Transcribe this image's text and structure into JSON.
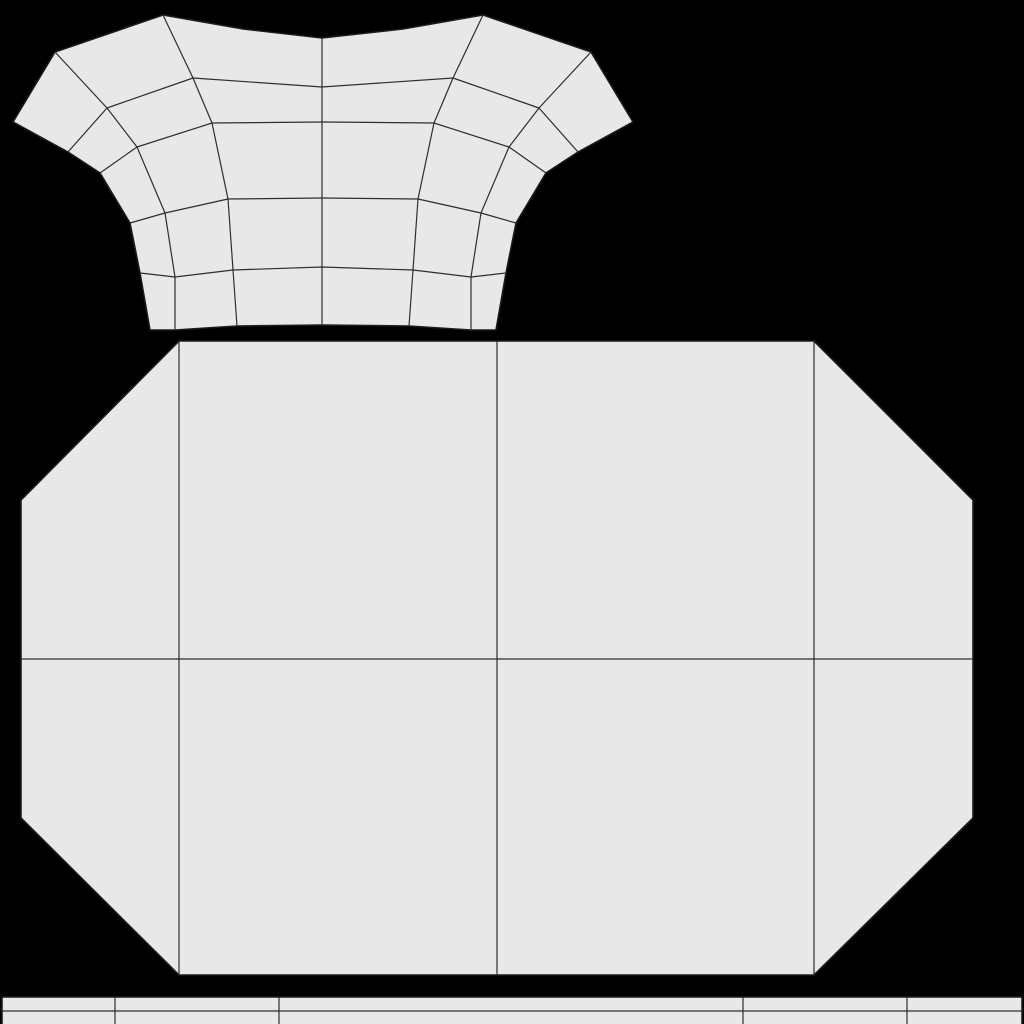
{
  "canvas": {
    "width": 1024,
    "height": 1024,
    "background_color": "#000000"
  },
  "style": {
    "island_fill_color": "#e8e8e8",
    "outline_color": "#1c1c1c",
    "wire_color": "#2e2e2e",
    "outline_width": 1.6,
    "wire_width": 1.2
  },
  "islands": [
    {
      "id": "torso-uv-island",
      "outline": [
        [
          13,
          122
        ],
        [
          55,
          52
        ],
        [
          163,
          15
        ],
        [
          243,
          29
        ],
        [
          322,
          38
        ],
        [
          403,
          29
        ],
        [
          483,
          15
        ],
        [
          591,
          52
        ],
        [
          633,
          122
        ],
        [
          578,
          152
        ],
        [
          546,
          173
        ],
        [
          516,
          223
        ],
        [
          506,
          273
        ],
        [
          496,
          330
        ],
        [
          471,
          330
        ],
        [
          409,
          326
        ],
        [
          322,
          325
        ],
        [
          237,
          326
        ],
        [
          175,
          330
        ],
        [
          150,
          330
        ],
        [
          140,
          273
        ],
        [
          130,
          223
        ],
        [
          100,
          173
        ],
        [
          68,
          152
        ]
      ],
      "wires": [
        [
          [
            322,
            38
          ],
          [
            322,
            87
          ],
          [
            322,
            122
          ],
          [
            322,
            198
          ],
          [
            322,
            267
          ],
          [
            322,
            325
          ]
        ],
        [
          [
            163,
            15
          ],
          [
            193,
            78
          ],
          [
            212,
            123
          ],
          [
            228,
            199
          ],
          [
            233,
            270
          ],
          [
            237,
            326
          ]
        ],
        [
          [
            55,
            52
          ],
          [
            107,
            108
          ],
          [
            137,
            147
          ],
          [
            165,
            213
          ],
          [
            175,
            277
          ],
          [
            175,
            330
          ]
        ],
        [
          [
            483,
            15
          ],
          [
            453,
            78
          ],
          [
            434,
            123
          ],
          [
            418,
            199
          ],
          [
            413,
            270
          ],
          [
            409,
            326
          ]
        ],
        [
          [
            591,
            52
          ],
          [
            539,
            108
          ],
          [
            509,
            147
          ],
          [
            481,
            213
          ],
          [
            471,
            277
          ],
          [
            471,
            330
          ]
        ],
        [
          [
            68,
            152
          ],
          [
            107,
            108
          ],
          [
            193,
            78
          ],
          [
            322,
            87
          ],
          [
            453,
            78
          ],
          [
            539,
            108
          ],
          [
            578,
            152
          ]
        ],
        [
          [
            100,
            173
          ],
          [
            137,
            147
          ],
          [
            212,
            123
          ],
          [
            322,
            122
          ],
          [
            434,
            123
          ],
          [
            509,
            147
          ],
          [
            546,
            173
          ]
        ],
        [
          [
            130,
            223
          ],
          [
            165,
            213
          ],
          [
            228,
            199
          ],
          [
            322,
            198
          ],
          [
            418,
            199
          ],
          [
            481,
            213
          ],
          [
            516,
            223
          ]
        ],
        [
          [
            140,
            273
          ],
          [
            175,
            277
          ],
          [
            233,
            270
          ],
          [
            322,
            267
          ],
          [
            413,
            270
          ],
          [
            471,
            277
          ],
          [
            506,
            273
          ]
        ]
      ]
    },
    {
      "id": "body-panel-uv-island",
      "outline": [
        [
          179,
          341
        ],
        [
          814,
          341
        ],
        [
          973,
          500
        ],
        [
          973,
          818
        ],
        [
          814,
          975
        ],
        [
          179,
          975
        ],
        [
          21,
          818
        ],
        [
          21,
          500
        ]
      ],
      "wires": [
        [
          [
            179,
            341
          ],
          [
            179,
            975
          ]
        ],
        [
          [
            497,
            341
          ],
          [
            497,
            975
          ]
        ],
        [
          [
            814,
            341
          ],
          [
            814,
            975
          ]
        ],
        [
          [
            21,
            659
          ],
          [
            973,
            659
          ]
        ]
      ]
    },
    {
      "id": "trim-strip-uv-island",
      "outline": [
        [
          2,
          997
        ],
        [
          1022,
          997
        ],
        [
          1022,
          1026
        ],
        [
          2,
          1026
        ]
      ],
      "wires": [
        [
          [
            2,
            1011
          ],
          [
            1022,
            1011
          ]
        ],
        [
          [
            115,
            997
          ],
          [
            115,
            1026
          ]
        ],
        [
          [
            279,
            997
          ],
          [
            279,
            1026
          ]
        ],
        [
          [
            743,
            997
          ],
          [
            743,
            1026
          ]
        ],
        [
          [
            907,
            997
          ],
          [
            907,
            1026
          ]
        ]
      ]
    }
  ]
}
